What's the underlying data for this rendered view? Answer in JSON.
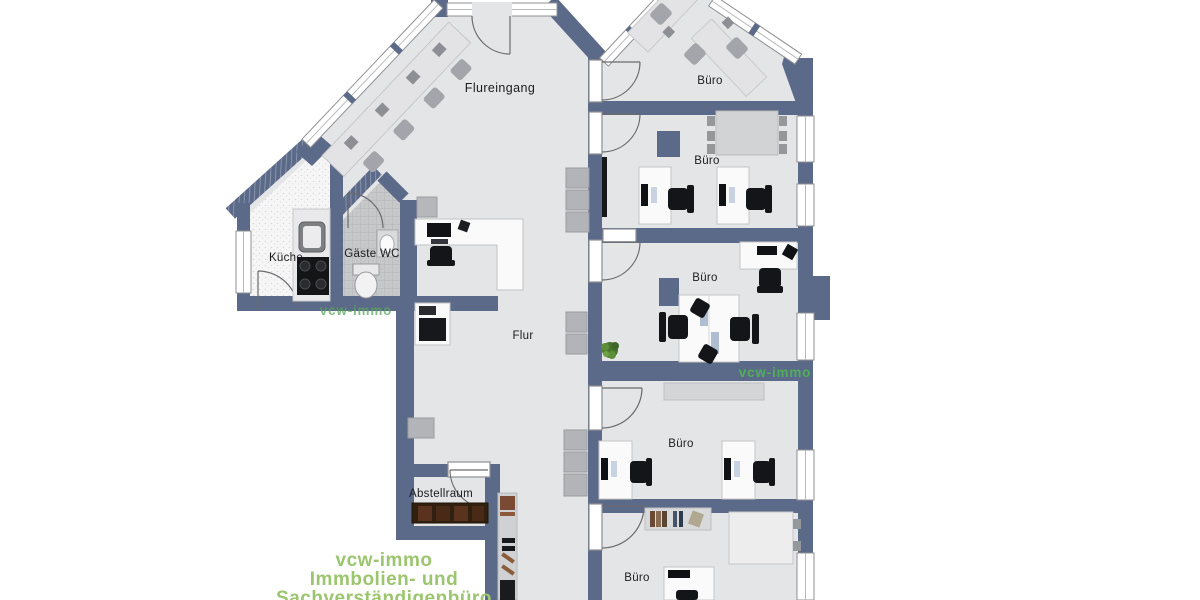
{
  "plan": {
    "rooms": {
      "flureingang": {
        "label": "Flureingang"
      },
      "buero_top": {
        "label": "Büro"
      },
      "buero_upper": {
        "label": "Büro"
      },
      "buero_middle": {
        "label": "Büro"
      },
      "buero_lower": {
        "label": "Büro"
      },
      "buero_bottom": {
        "label": "Büro"
      },
      "kueche": {
        "label": "Küche"
      },
      "gaeste_wc": {
        "label": "Gäste WC"
      },
      "flur": {
        "label": "Flur"
      },
      "abstellraum": {
        "label": "Abstellraum"
      }
    },
    "watermarks": {
      "left": "vcw-immo",
      "right": "vcw-immo"
    },
    "footer": {
      "line1": "vcw-immo",
      "line2": "Immbolien- und",
      "line3": "Sachverständigenbüro"
    },
    "colors": {
      "wall": "#5c6a89",
      "floor": "#e4e5e7",
      "wc_floor": "#c7c8ca",
      "accent_green": "#4fae57",
      "footer_green": "#9cc56f"
    }
  }
}
